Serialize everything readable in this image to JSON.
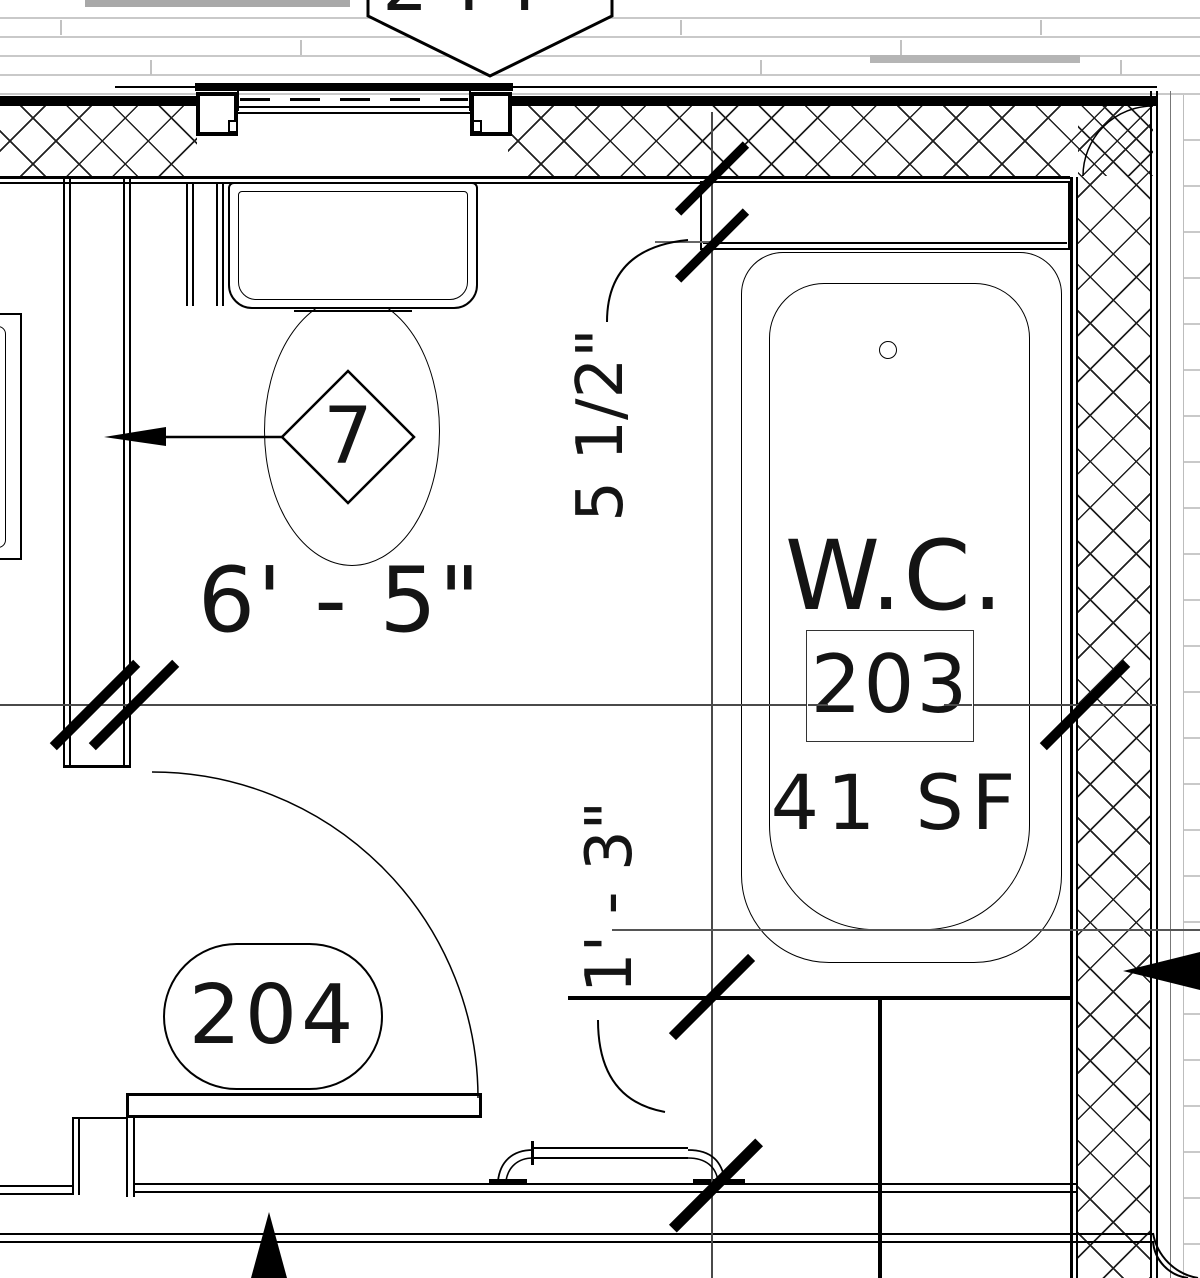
{
  "labels": {
    "room_name": "W.C.",
    "room_number": "203",
    "room_area": "41 SF",
    "door_tag": "204",
    "keynote": "7",
    "window_tag_partial": "244",
    "dim_horizontal": "6' - 5\"",
    "dim_offset": "5 1/2\"",
    "dim_vertical": "1' - 3\""
  },
  "colors": {
    "line": "#000000",
    "dimension_line": "#4a4a4a",
    "siding": "#c9c9c9"
  }
}
